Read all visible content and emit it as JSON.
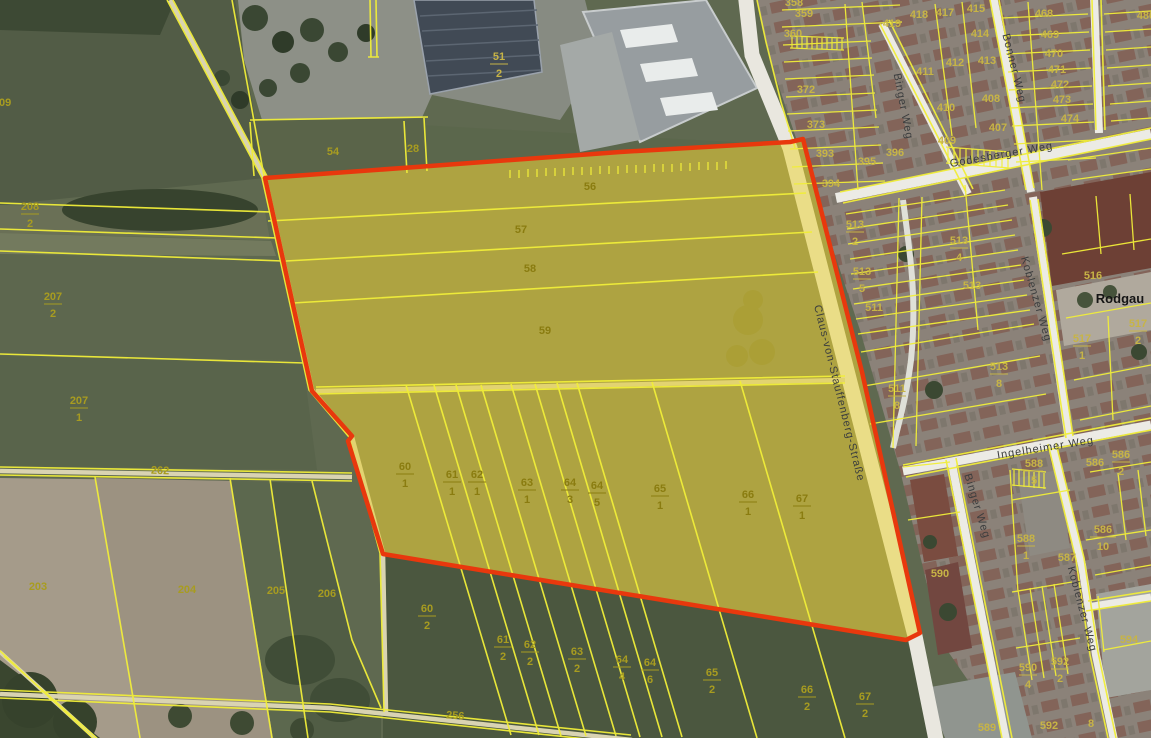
{
  "map": {
    "colors": {
      "parcel_line": "#f1ee39",
      "selection_outline": "#e8380d",
      "selection_fill": "#ecd32f",
      "parcel_label": "#c7b446",
      "street_text": "#3b3d3e"
    },
    "place_labels": [
      {
        "text": "Rodgau",
        "x": 1120,
        "y": 303
      }
    ],
    "street_labels": [
      {
        "text": "Claus-von-Stauffenberg-Straße",
        "x": 836,
        "y": 394,
        "rot": 76
      },
      {
        "text": "Godesberger Weg",
        "x": 1002,
        "y": 158,
        "rot": -10
      },
      {
        "text": "Binger Weg",
        "x": 900,
        "y": 107,
        "rot": 79
      },
      {
        "text": "Bonner Weg",
        "x": 1011,
        "y": 69,
        "rot": 76
      },
      {
        "text": "Koblenzer Weg",
        "x": 1033,
        "y": 300,
        "rot": 74
      },
      {
        "text": "Ingelheimer Weg",
        "x": 1046,
        "y": 451,
        "rot": -9
      },
      {
        "text": "Binger Weg",
        "x": 974,
        "y": 507,
        "rot": 73
      },
      {
        "text": "Koblenzer Weg",
        "x": 1079,
        "y": 610,
        "rot": 75
      }
    ],
    "parcel_labels": [
      {
        "n": "209",
        "x": 2,
        "y": 106,
        "c": "dim"
      },
      {
        "n": "208",
        "d": "2",
        "x": 30,
        "y": 210,
        "c": "dim"
      },
      {
        "n": "207",
        "d": "2",
        "x": 53,
        "y": 300,
        "c": "dim"
      },
      {
        "n": "207",
        "d": "1",
        "x": 79,
        "y": 404,
        "c": "dim"
      },
      {
        "n": "262",
        "x": 160,
        "y": 474,
        "c": "dim",
        "rot": 2
      },
      {
        "n": "203",
        "x": 38,
        "y": 590,
        "c": "dim"
      },
      {
        "n": "204",
        "x": 187,
        "y": 593,
        "c": "dim"
      },
      {
        "n": "205",
        "x": 276,
        "y": 594,
        "c": "dim"
      },
      {
        "n": "206",
        "x": 327,
        "y": 597,
        "c": "dim"
      },
      {
        "n": "54",
        "x": 333,
        "y": 155,
        "c": "dim"
      },
      {
        "n": "28",
        "x": 413,
        "y": 152,
        "c": "dim"
      },
      {
        "n": "51",
        "d": "2",
        "x": 499,
        "y": 60
      },
      {
        "n": "256",
        "x": 455,
        "y": 719,
        "c": "dim",
        "rot": 4
      },
      {
        "n": "56",
        "x": 590,
        "y": 190,
        "c": "hl"
      },
      {
        "n": "57",
        "x": 521,
        "y": 233,
        "c": "hl"
      },
      {
        "n": "58",
        "x": 530,
        "y": 272,
        "c": "hl"
      },
      {
        "n": "59",
        "x": 545,
        "y": 334,
        "c": "hl"
      },
      {
        "n": "60",
        "d": "1",
        "x": 405,
        "y": 470,
        "c": "hl"
      },
      {
        "n": "61",
        "d": "1",
        "x": 452,
        "y": 478,
        "c": "hl"
      },
      {
        "n": "62",
        "d": "1",
        "x": 477,
        "y": 478,
        "c": "hl"
      },
      {
        "n": "63",
        "d": "1",
        "x": 527,
        "y": 486,
        "c": "hl"
      },
      {
        "n": "64",
        "d": "3",
        "x": 570,
        "y": 486,
        "c": "hl"
      },
      {
        "n": "64",
        "d": "5",
        "x": 597,
        "y": 489,
        "c": "hl"
      },
      {
        "n": "65",
        "d": "1",
        "x": 660,
        "y": 492,
        "c": "hl"
      },
      {
        "n": "66",
        "d": "1",
        "x": 748,
        "y": 498,
        "c": "hl"
      },
      {
        "n": "67",
        "d": "1",
        "x": 802,
        "y": 502,
        "c": "hl"
      },
      {
        "n": "60",
        "d": "2",
        "x": 427,
        "y": 612,
        "c": "dim"
      },
      {
        "n": "61",
        "d": "2",
        "x": 503,
        "y": 643,
        "c": "dim"
      },
      {
        "n": "62",
        "d": "2",
        "x": 530,
        "y": 648,
        "c": "dim"
      },
      {
        "n": "63",
        "d": "2",
        "x": 577,
        "y": 655,
        "c": "dim"
      },
      {
        "n": "64",
        "d": "4",
        "x": 622,
        "y": 663,
        "c": "dim"
      },
      {
        "n": "64",
        "d": "6",
        "x": 650,
        "y": 666,
        "c": "dim"
      },
      {
        "n": "65",
        "d": "2",
        "x": 712,
        "y": 676,
        "c": "dim"
      },
      {
        "n": "66",
        "d": "2",
        "x": 807,
        "y": 693,
        "c": "dim"
      },
      {
        "n": "67",
        "d": "2",
        "x": 865,
        "y": 700,
        "c": "dim"
      },
      {
        "n": "358",
        "x": 794,
        "y": 6
      },
      {
        "n": "359",
        "x": 804,
        "y": 17
      },
      {
        "n": "360",
        "x": 793,
        "y": 37
      },
      {
        "n": "372",
        "x": 806,
        "y": 93
      },
      {
        "n": "373",
        "x": 816,
        "y": 128
      },
      {
        "n": "393",
        "x": 825,
        "y": 157
      },
      {
        "n": "394",
        "x": 831,
        "y": 187
      },
      {
        "n": "395",
        "x": 867,
        "y": 165
      },
      {
        "n": "396",
        "x": 895,
        "y": 156
      },
      {
        "n": "409",
        "x": 947,
        "y": 144
      },
      {
        "n": "410",
        "x": 946,
        "y": 111
      },
      {
        "n": "411",
        "x": 925,
        "y": 75
      },
      {
        "n": "412",
        "x": 955,
        "y": 66
      },
      {
        "n": "413",
        "x": 987,
        "y": 64
      },
      {
        "n": "407",
        "x": 998,
        "y": 131
      },
      {
        "n": "408",
        "x": 991,
        "y": 102
      },
      {
        "n": "414",
        "x": 980,
        "y": 37
      },
      {
        "n": "415",
        "x": 976,
        "y": 12
      },
      {
        "n": "417",
        "x": 945,
        "y": 16
      },
      {
        "n": "418",
        "x": 919,
        "y": 18
      },
      {
        "n": "419",
        "x": 892,
        "y": 27
      },
      {
        "n": "468",
        "x": 1044,
        "y": 17
      },
      {
        "n": "469",
        "x": 1050,
        "y": 38
      },
      {
        "n": "470",
        "x": 1054,
        "y": 57
      },
      {
        "n": "471",
        "x": 1057,
        "y": 73
      },
      {
        "n": "472",
        "x": 1060,
        "y": 88
      },
      {
        "n": "473",
        "x": 1062,
        "y": 103
      },
      {
        "n": "474",
        "x": 1070,
        "y": 122
      },
      {
        "n": "480",
        "x": 1146,
        "y": 19
      },
      {
        "n": "513",
        "d": "2",
        "x": 855,
        "y": 228
      },
      {
        "n": "513",
        "d": "5",
        "x": 862,
        "y": 275
      },
      {
        "n": "511",
        "x": 874,
        "y": 311
      },
      {
        "n": "513",
        "d": "4",
        "x": 959,
        "y": 244
      },
      {
        "n": "513",
        "x": 972,
        "y": 289
      },
      {
        "n": "511",
        "d": "8",
        "x": 897,
        "y": 392
      },
      {
        "n": "513",
        "d": "8",
        "x": 999,
        "y": 370
      },
      {
        "n": "516",
        "x": 1093,
        "y": 279
      },
      {
        "n": "517",
        "d": "1",
        "x": 1082,
        "y": 342
      },
      {
        "n": "517",
        "d": "2",
        "x": 1138,
        "y": 327
      },
      {
        "n": "588",
        "d": "5",
        "x": 1034,
        "y": 467
      },
      {
        "n": "588",
        "d": "1",
        "x": 1026,
        "y": 542
      },
      {
        "n": "590",
        "x": 940,
        "y": 577
      },
      {
        "n": "587",
        "x": 1067,
        "y": 561
      },
      {
        "n": "586",
        "x": 1095,
        "y": 466
      },
      {
        "n": "586",
        "d": "2",
        "x": 1121,
        "y": 458
      },
      {
        "n": "586",
        "d": "10",
        "x": 1103,
        "y": 533
      },
      {
        "n": "594",
        "x": 1129,
        "y": 643
      },
      {
        "n": "590",
        "d": "4",
        "x": 1028,
        "y": 671
      },
      {
        "n": "592",
        "d": "2",
        "x": 1060,
        "y": 665
      },
      {
        "n": "592",
        "x": 1049,
        "y": 729
      },
      {
        "n": "8",
        "x": 1091,
        "y": 727
      },
      {
        "n": "589",
        "x": 987,
        "y": 731
      }
    ]
  }
}
